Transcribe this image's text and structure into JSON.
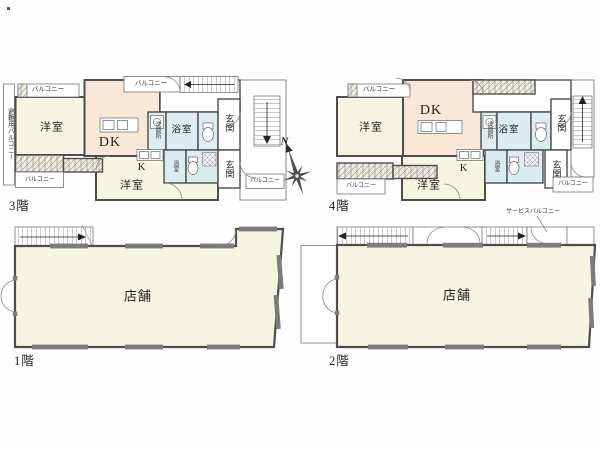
{
  "compass": {
    "north": "N"
  },
  "floor3": {
    "label": "3階",
    "rooms": {
      "western1": "洋室",
      "western2": "洋室",
      "dk": "DK",
      "kitchen": "K",
      "washroom": "洗面所",
      "bath": "浴室",
      "bath2": "浴室",
      "entrance1": "玄関",
      "entrance2": "玄関",
      "balcony_top_left": "バルコニー",
      "balcony_top_center": "バルコニー",
      "balcony_bottom_left": "バルコニー",
      "balcony_bottom_right": "バルコニー",
      "evacuation_balcony": "避難用バルコニー"
    }
  },
  "floor4": {
    "label": "4階",
    "rooms": {
      "western1": "洋室",
      "western2": "洋室",
      "dk": "DK",
      "kitchen": "K",
      "washroom": "洗面所",
      "bath": "浴室",
      "bath2": "浴室",
      "entrance1": "玄関",
      "entrance2": "玄関",
      "balcony_top_left": "バルコニー",
      "balcony_bottom_left": "バルコニー",
      "balcony_bottom_right": "バルコニー"
    }
  },
  "floor1": {
    "label": "1階",
    "rooms": {
      "shop": "店舗"
    }
  },
  "floor2": {
    "label": "2階",
    "rooms": {
      "shop": "店舗",
      "service_balcony": "サービスバルコニー"
    }
  }
}
